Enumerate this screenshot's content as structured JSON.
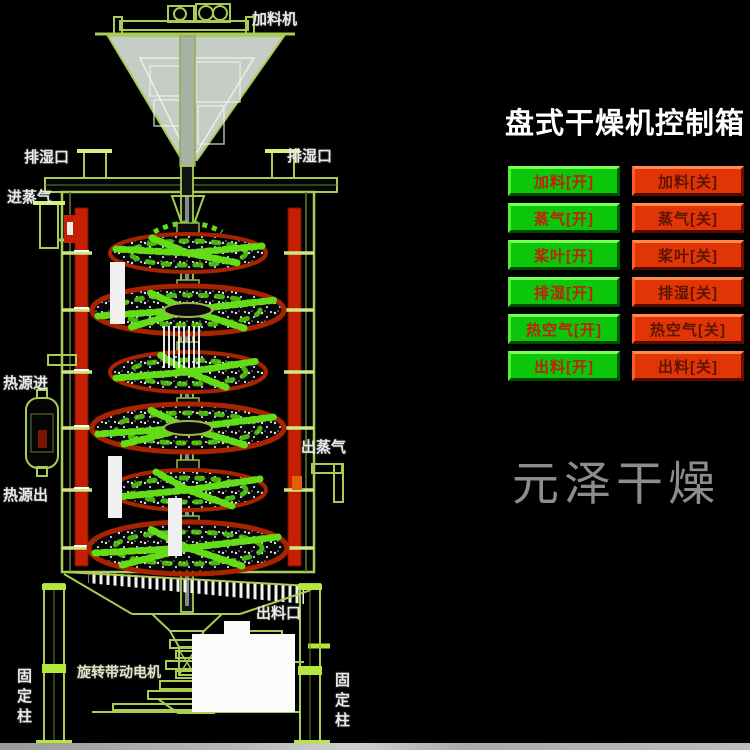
{
  "watermark": "元泽干燥",
  "panel": {
    "title": "盘式干燥机控制箱",
    "rows": [
      {
        "on": "加料[开]",
        "off": "加料[关]"
      },
      {
        "on": "蒸气[开]",
        "off": "蒸气[关]"
      },
      {
        "on": "桨叶[开]",
        "off": "桨叶[关]"
      },
      {
        "on": "排湿[开]",
        "off": "排湿[关]"
      },
      {
        "on": "热空气[开]",
        "off": "热空气[关]"
      },
      {
        "on": "出料[开]",
        "off": "出料[关]"
      }
    ]
  },
  "diagram": {
    "labels": {
      "feeder": "加料机",
      "vent_left": "排湿口",
      "vent_right": "排湿口",
      "steam_in": "进蒸气",
      "heat_in": "热源进",
      "heat_out": "热源出",
      "steam_out": "出蒸气",
      "discharge": "出料口",
      "motor": "旋转带动电机",
      "column_left": "固定柱",
      "column_right": "固定柱"
    }
  },
  "colors": {
    "button_on": "#0bc60b",
    "button_off": "#e23507",
    "panel_title": "#ffffff",
    "diagram_line": "#a8cc55",
    "jacket_red": "#c41f00",
    "disc_rim": "#a82300",
    "particle_green": "#63dd17",
    "watermark_gray": "#8d8d8d",
    "floor_gray": "#b5b5b5"
  }
}
